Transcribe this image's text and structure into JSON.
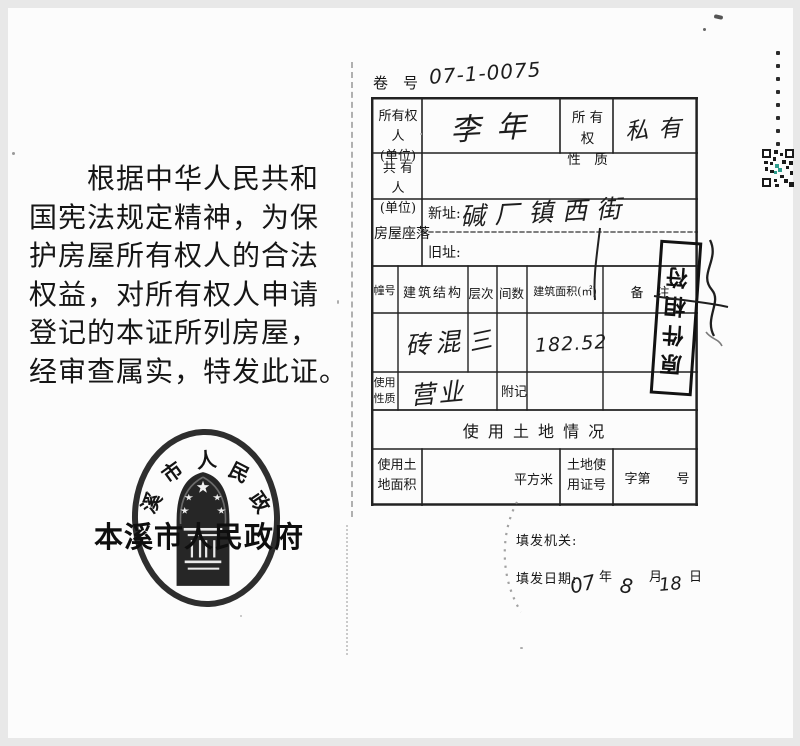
{
  "left": {
    "paragraph": "　　根据中华人民共和\n国宪法规定精神，为保\n护房屋所有权人的合法\n权益，对所有权人申请\n登记的本证所列房屋，\n经审查属实，特发此证。",
    "seal": {
      "arc": [
        "溪",
        "市",
        "人",
        "民",
        "政"
      ],
      "authority": "本溪市人民政府"
    }
  },
  "form": {
    "volume": {
      "label": "卷　号",
      "value": "07-1-0075"
    },
    "owner": {
      "label": "所有权人\n(单位)",
      "value": "李年"
    },
    "nature": {
      "label": "所 有 权\n性　质",
      "value": "私有"
    },
    "coowner": {
      "label": "共 有 人\n(单位)",
      "value": ""
    },
    "location": {
      "label": "房屋座落",
      "new_label": "新址:",
      "new_value": "碱厂镇西街",
      "old_label": "旧址:",
      "old_value": ""
    },
    "building_table": {
      "headers": [
        "幢号",
        "建筑结构",
        "层次",
        "间数",
        "建筑面积(㎡)",
        "备　注"
      ],
      "row": {
        "structure": "砖混",
        "floors": "三",
        "rooms": "",
        "area": "182.52",
        "note": ""
      }
    },
    "usage": {
      "label": "使用\n性质",
      "value": "营业"
    },
    "annex": {
      "label": "附记",
      "value": ""
    },
    "land_section": {
      "title": "使 用 土 地 情 况",
      "area_label": "使用土\n地面积",
      "sqm_label": "平方米",
      "cert_label": "土地使\n用证号",
      "cert_no_label": "字第　　号"
    }
  },
  "footer": {
    "issuer_label": "填发机关:",
    "date_label": "填发日期:",
    "year_value": "07",
    "year_unit": "年",
    "month_value": "8",
    "month_unit": "月",
    "day_value": "18",
    "day_unit": "日"
  },
  "stamps": {
    "match_stamp_text": "原件相符"
  },
  "colors": {
    "ink": "#1b1b1b",
    "qr_accent": "#2e9e8e"
  }
}
